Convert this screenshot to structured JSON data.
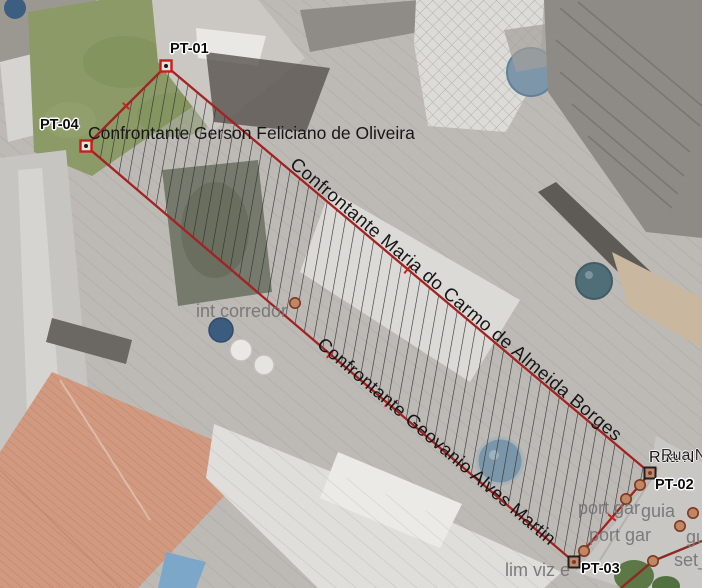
{
  "parcel": {
    "points": [
      {
        "id": "PT-01"
      },
      {
        "id": "PT-02"
      },
      {
        "id": "PT-03"
      },
      {
        "id": "PT-04"
      }
    ],
    "neighbors": {
      "top": "Confrontante Gerson Feliciano de Oliveira",
      "right": "Confrontante Maria do Carmo de Almeida Borges",
      "left": "Confrontante Geovanio Alves Martin"
    }
  },
  "street": {
    "name": "Rua N"
  },
  "annotations": [
    {
      "text": "int corredor"
    },
    {
      "text": "port gar"
    },
    {
      "text": "guia"
    },
    {
      "text": "port gar"
    },
    {
      "text": "gu"
    },
    {
      "text": "set_"
    },
    {
      "text": "lim viz e"
    }
  ],
  "colors": {
    "boundary_red": "#a32222",
    "sketch_dark_red": "#8b2a20",
    "vertex_red": "#cf1b1b",
    "vertex_tan_fill": "#c08a6a",
    "hatch": "#2e2e2e",
    "annotation_gray": "#767676",
    "grass_green": "#8b9a66",
    "terracotta_roof": "#d19a80",
    "water_tank_blue": "#7e96aa"
  }
}
